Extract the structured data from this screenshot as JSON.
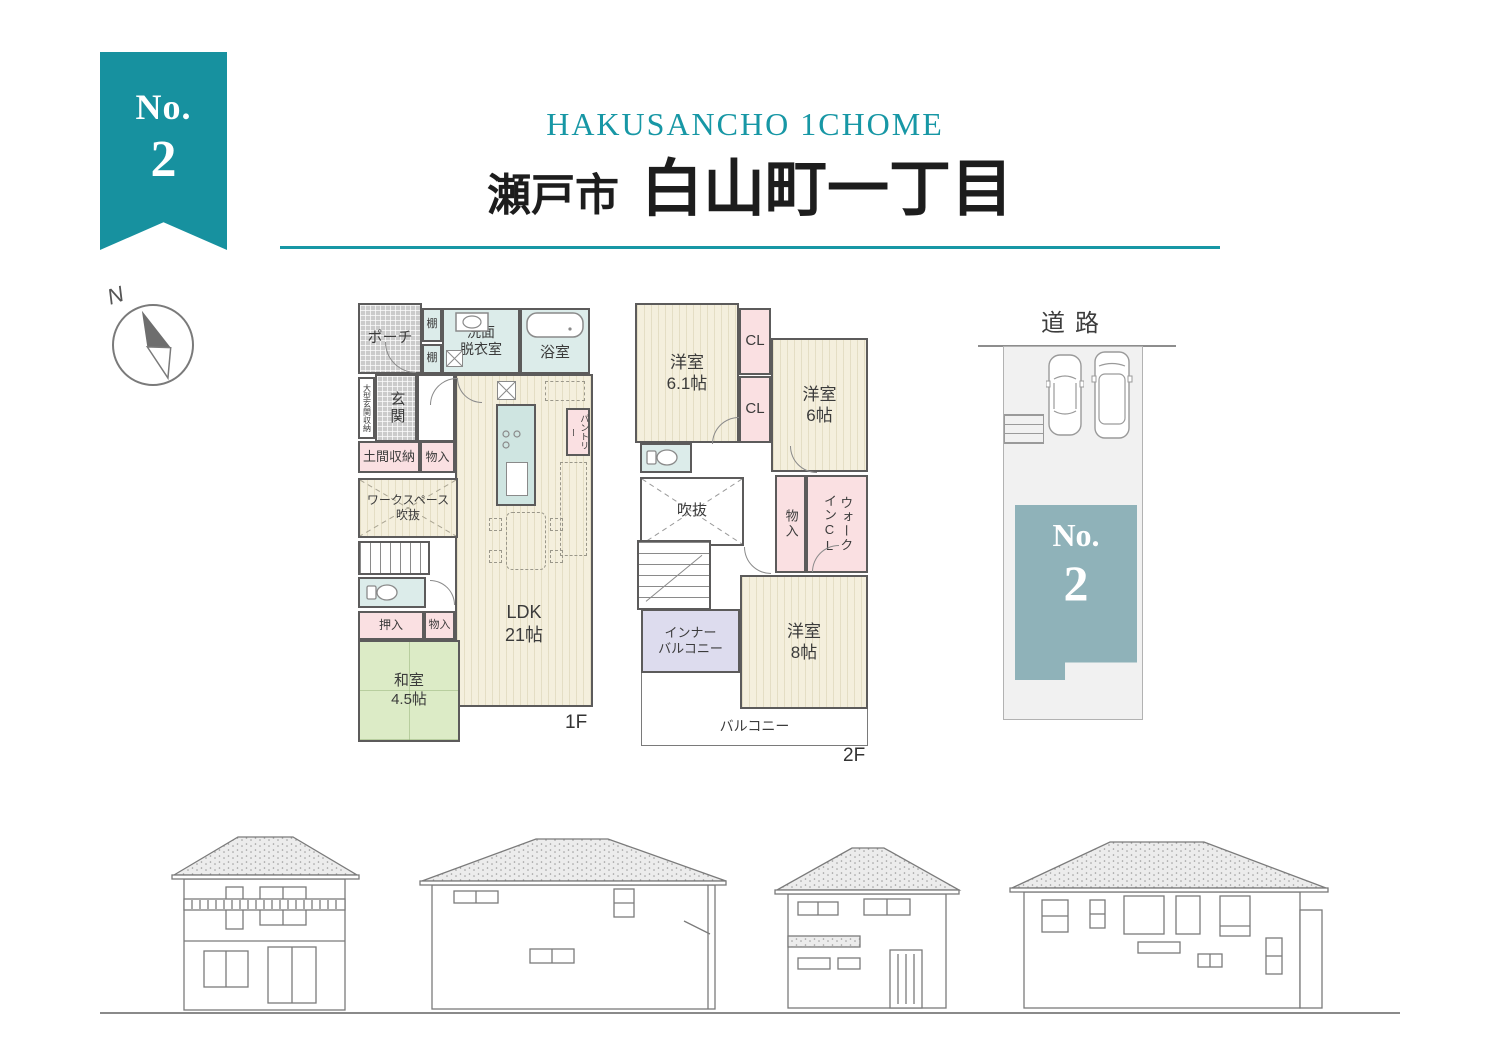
{
  "badge": {
    "label": "No.",
    "number": "2"
  },
  "header": {
    "subtitle": "HAKUSANCHO 1CHOME",
    "city": "瀬戸市",
    "town": "白山町一丁目"
  },
  "compass": {
    "north": "N"
  },
  "floor1": {
    "label": "1F",
    "rooms": {
      "porch": "ポーチ",
      "shelf_top": "棚",
      "shelf_bottom": "棚",
      "washroom": "洗面\n脱衣室",
      "bath": "浴室",
      "entrance": "玄関",
      "entrance_storage": "大型玄関収納",
      "doma_storage": "土間収納",
      "storage_a": "物入",
      "workspace": "ワークスペース\n吹抜",
      "pantry": "パントリー",
      "oshiire": "押入",
      "storage_b": "物入",
      "washitsu": "和室\n4.5帖",
      "ldk": "LDK\n21帖"
    }
  },
  "floor2": {
    "label": "2F",
    "rooms": {
      "bedroom1": "洋室\n6.1帖",
      "closet1": "CL",
      "closet2": "CL",
      "bedroom2": "洋室\n6帖",
      "void": "吹抜",
      "storage": "物入",
      "walkin_closet": "ウォーク\nインCL",
      "bedroom3": "洋室\n8帖",
      "inner_balcony": "インナー\nバルコニー",
      "balcony": "バルコニー"
    }
  },
  "site": {
    "road": "道路",
    "plot_label": "No.",
    "plot_number": "2"
  },
  "colors": {
    "accent_teal": "#17919f",
    "title_teal": "#1797a5",
    "plot_fill": "#8fb2b9",
    "wall": "#5c5b5b"
  }
}
